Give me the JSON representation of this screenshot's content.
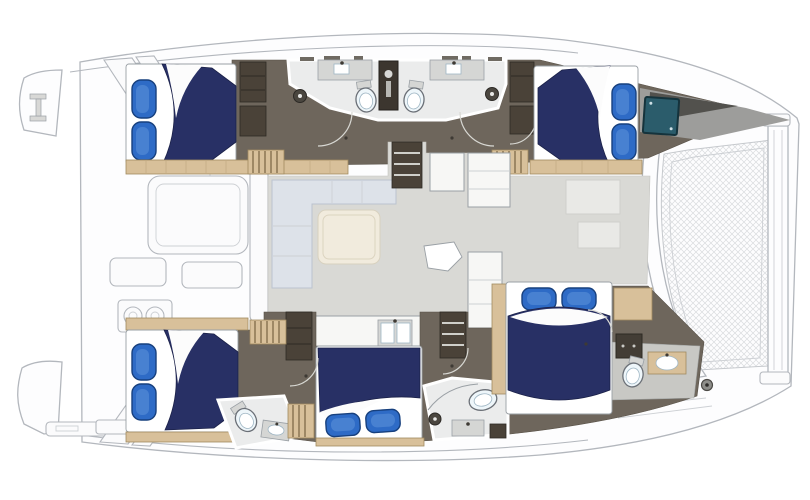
{
  "diagram": {
    "type": "floor-plan",
    "subject": "catamaran-yacht-deck-plan",
    "orientation": {
      "bow": "right",
      "stern": "left"
    },
    "rooms": [
      {
        "name": "aft-cockpit",
        "items": [
          "cockpit-table",
          "bench-seat",
          "grill",
          "transom-steps",
          "swim-platform",
          "davits"
        ]
      },
      {
        "name": "salon",
        "items": [
          "l-sofa",
          "coffee-table",
          "side-table",
          "cabinets",
          "refrigerator-counter",
          "galley-counter",
          "galley-sink",
          "companionway-stairs-port",
          "companionway-stairs-starboard"
        ]
      },
      {
        "name": "port-aft-cabin",
        "items": [
          "double-bed",
          "pillows",
          "wardrobe",
          "walkway"
        ]
      },
      {
        "name": "port-heads",
        "items": [
          "toilet",
          "toilet",
          "sink-counter",
          "sink-counter",
          "shower",
          "shower",
          "wet-locker"
        ]
      },
      {
        "name": "port-forward-cabin",
        "items": [
          "double-bed",
          "pillows",
          "wardrobe",
          "seat-hatch"
        ]
      },
      {
        "name": "starboard-aft-cabin",
        "items": [
          "double-bed",
          "pillows",
          "toilet",
          "sink"
        ]
      },
      {
        "name": "starboard-mid-cabin",
        "items": [
          "double-bed",
          "pillows"
        ]
      },
      {
        "name": "starboard-mid-bathroom",
        "items": [
          "shower",
          "sink",
          "vanity-counter",
          "locker"
        ]
      },
      {
        "name": "starboard-forward-cabin",
        "items": [
          "double-bed",
          "pillows",
          "toilet",
          "sink",
          "cabinet"
        ]
      },
      {
        "name": "bow",
        "items": [
          "trampoline",
          "crossbeam",
          "anchor-fitting"
        ]
      }
    ],
    "counts": {
      "beds": 5,
      "pillows": 10,
      "toilets": 4,
      "showers": 3,
      "sinks": 6
    }
  },
  "colors": {
    "hull-stroke": "#b3b7bd",
    "floor-taupe": "#6e665c",
    "floor-salon": "#d9d9d5",
    "floor-head": "#ebecec",
    "floor-gray": "#c8c8c4",
    "wood": "#d8c09a",
    "wood-stroke": "#a08a60",
    "wood-rib": "#8f7a58",
    "bed-navy": "#283065",
    "bed-navy-dark": "#1b2148",
    "pillow-blue": "#2e6bc6",
    "pillow-dark": "#17407e",
    "pillow-light": "#5a8fd8",
    "panel": "#f7f7f5",
    "panel-stroke": "#9aa0a5",
    "dark-wood": "#4a4238",
    "dark-wood-deep": "#2e2a24",
    "sofa": "#dde2e9",
    "sofa-stroke": "#bac3cf",
    "cream": "#f1ebdd",
    "teal": "#2b5c6b",
    "fixture": "#eef6fa",
    "fixture-stroke": "#6b7077",
    "counter": "#d5d6d4",
    "arc": "#d8d8d3",
    "wedge": "#9d9d9b",
    "wedge-dark": "#52514d",
    "mesh-line": "#d9dbde"
  }
}
